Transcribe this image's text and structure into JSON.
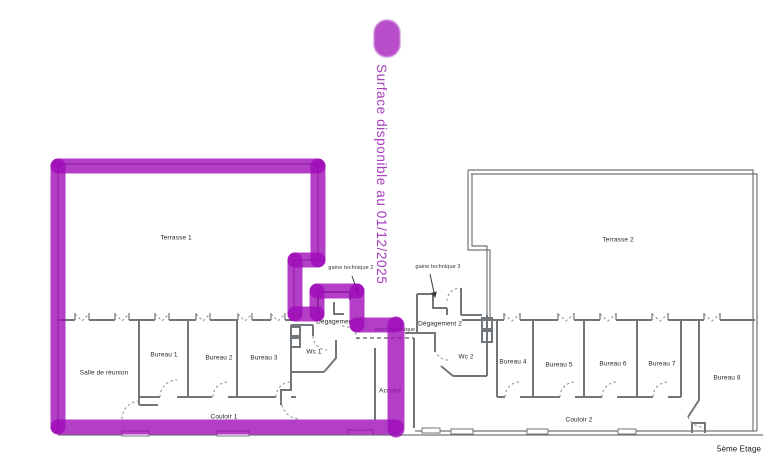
{
  "caption": "Surface disponible au 01/12/2025",
  "floor_note": "5ème Etage",
  "rooms": {
    "terrasse1": "Terrasse 1",
    "terrasse2": "Terrasse 2",
    "salle_reunion": "Salle de réunion",
    "bureau1": "Bureau 1",
    "bureau2": "Bureau 2",
    "bureau3": "Bureau 3",
    "bureau4": "Bureau 4",
    "bureau5": "Bureau 5",
    "bureau6": "Bureau 6",
    "bureau7": "Bureau 7",
    "bureau8": "Bureau 8",
    "couloir1": "Couloir 1",
    "couloir2": "Couloir 2",
    "wc1": "Wc 1",
    "wc2": "Wc 2",
    "degagement1": "Dégagement 1",
    "degagement2": "Dégagement 2",
    "gaine_technique2": "gaine technique 2",
    "gaine_technique3": "gaine technique 3",
    "gaine_technique": "gaine technique",
    "accueil": "Accueil"
  },
  "colors": {
    "highlight": "#9c09b6",
    "highlight_fill": "#b23fc6",
    "caption_text": "#a93fbe",
    "wall": "#71767b",
    "door": "#8a8f94",
    "annotation": "#3a3a3a",
    "label_text": "#26272b"
  }
}
